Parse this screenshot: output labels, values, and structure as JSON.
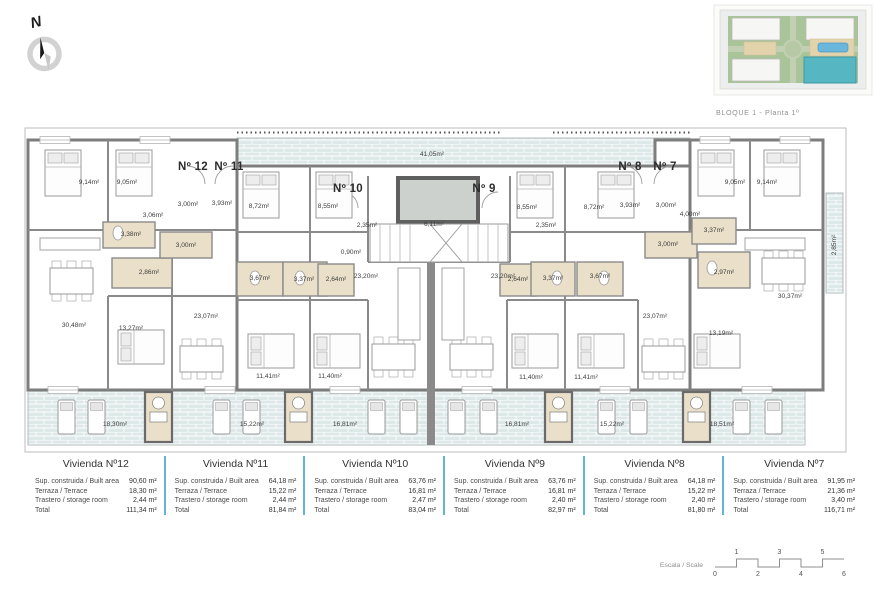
{
  "compass": {
    "letter": "N"
  },
  "site_plan": {
    "caption": "BLOQUE 1 - Planta 1º"
  },
  "colors": {
    "wall": "#7d7d7d",
    "terrace_fill": "#dde8e9",
    "bath_fill": "#eadfc8",
    "elevator_fill": "#cdd1cd",
    "table_divider": "#63b4d8",
    "site_green": "#a9c499",
    "site_highlight_teal": "#56b7c3",
    "site_pool_blue": "#69b7dc"
  },
  "plan": {
    "apartment_labels": [
      {
        "text": "Nº 12",
        "x": 193,
        "y": 170
      },
      {
        "text": "Nº 11",
        "x": 229,
        "y": 170
      },
      {
        "text": "Nº 10",
        "x": 348,
        "y": 192
      },
      {
        "text": "Nº 9",
        "x": 484,
        "y": 192
      },
      {
        "text": "Nº 8",
        "x": 630,
        "y": 170
      },
      {
        "text": "Nº 7",
        "x": 665,
        "y": 170
      }
    ],
    "room_labels": [
      {
        "t": "9,14m²",
        "x": 89,
        "y": 184
      },
      {
        "t": "9,05m²",
        "x": 127,
        "y": 184
      },
      {
        "t": "3,06m²",
        "x": 153,
        "y": 217
      },
      {
        "t": "3,00m²",
        "x": 188,
        "y": 206
      },
      {
        "t": "3,93m²",
        "x": 222,
        "y": 205
      },
      {
        "t": "3,38m²",
        "x": 131,
        "y": 236
      },
      {
        "t": "3,00m²",
        "x": 186,
        "y": 247
      },
      {
        "t": "2,86m²",
        "x": 149,
        "y": 274
      },
      {
        "t": "30,48m²",
        "x": 74,
        "y": 327
      },
      {
        "t": "13,27m²",
        "x": 131,
        "y": 330
      },
      {
        "t": "23,07m²",
        "x": 206,
        "y": 318
      },
      {
        "t": "8,72m²",
        "x": 259,
        "y": 208
      },
      {
        "t": "3,67m²",
        "x": 260,
        "y": 280
      },
      {
        "t": "3,37m²",
        "x": 304,
        "y": 281
      },
      {
        "t": "11,41m²",
        "x": 268,
        "y": 378
      },
      {
        "t": "8,55m²",
        "x": 328,
        "y": 208
      },
      {
        "t": "2,35m²",
        "x": 367,
        "y": 227
      },
      {
        "t": "0,90m²",
        "x": 351,
        "y": 254
      },
      {
        "t": "2,64m²",
        "x": 336,
        "y": 281
      },
      {
        "t": "23,20m²",
        "x": 366,
        "y": 278
      },
      {
        "t": "41,05m²",
        "x": 432,
        "y": 156
      },
      {
        "t": "6,11m²",
        "x": 434,
        "y": 226
      },
      {
        "t": "2,35m²",
        "x": 546,
        "y": 227
      },
      {
        "t": "23,20m²",
        "x": 503,
        "y": 278
      },
      {
        "t": "2,64m²",
        "x": 518,
        "y": 281
      },
      {
        "t": "3,37m²",
        "x": 553,
        "y": 280
      },
      {
        "t": "11,40m²",
        "x": 330,
        "y": 378
      },
      {
        "t": "11,40m²",
        "x": 531,
        "y": 379
      },
      {
        "t": "8,55m²",
        "x": 527,
        "y": 209
      },
      {
        "t": "8,72m²",
        "x": 594,
        "y": 209
      },
      {
        "t": "3,93m²",
        "x": 630,
        "y": 207
      },
      {
        "t": "3,00m²",
        "x": 666,
        "y": 207
      },
      {
        "t": "3,67m²",
        "x": 600,
        "y": 278
      },
      {
        "t": "3,00m²",
        "x": 668,
        "y": 246
      },
      {
        "t": "23,07m²",
        "x": 655,
        "y": 318
      },
      {
        "t": "11,41m²",
        "x": 586,
        "y": 379
      },
      {
        "t": "3,37m²",
        "x": 714,
        "y": 232
      },
      {
        "t": "4,00m²",
        "x": 690,
        "y": 216
      },
      {
        "t": "9,05m²",
        "x": 735,
        "y": 184
      },
      {
        "t": "9,14m²",
        "x": 767,
        "y": 184
      },
      {
        "t": "2,97m²",
        "x": 724,
        "y": 274
      },
      {
        "t": "30,37m²",
        "x": 790,
        "y": 298
      },
      {
        "t": "13,19m²",
        "x": 721,
        "y": 335
      },
      {
        "t": "2,85m²",
        "x": 836,
        "y": 245,
        "r": -90
      },
      {
        "t": "18,30m²",
        "x": 115,
        "y": 426
      },
      {
        "t": "15,22m²",
        "x": 252,
        "y": 426
      },
      {
        "t": "16,81m²",
        "x": 345,
        "y": 426
      },
      {
        "t": "16,81m²",
        "x": 517,
        "y": 426
      },
      {
        "t": "15,22m²",
        "x": 612,
        "y": 426
      },
      {
        "t": "18,51m²",
        "x": 722,
        "y": 426
      }
    ]
  },
  "table": {
    "row_labels": [
      "Sup. construida / Built area",
      "Terraza / Terrace",
      "Trastero / storage room",
      "Total"
    ],
    "units": [
      {
        "name": "Vivienda Nº12",
        "values": [
          "90,60 m²",
          "18,30 m²",
          "2,44 m²",
          "111,34 m²"
        ]
      },
      {
        "name": "Vivienda Nº11",
        "values": [
          "64,18 m²",
          "15,22 m²",
          "2,44 m²",
          "81,84 m²"
        ]
      },
      {
        "name": "Vivienda Nº10",
        "values": [
          "63,76 m²",
          "16,81 m²",
          "2,47 m²",
          "83,04 m²"
        ]
      },
      {
        "name": "Vivienda Nº9",
        "values": [
          "63,76 m²",
          "16,81 m²",
          "2,40 m²",
          "82,97 m²"
        ]
      },
      {
        "name": "Vivienda Nº8",
        "values": [
          "64,18 m²",
          "15,22 m²",
          "2,40 m²",
          "81,80 m²"
        ]
      },
      {
        "name": "Vivienda Nº7",
        "values": [
          "91,95 m²",
          "21,36 m²",
          "3,40 m²",
          "116,71 m²"
        ]
      }
    ]
  },
  "scale_bar": {
    "label": "Escala / Scale",
    "top_numbers": [
      "1",
      "3",
      "5"
    ],
    "bottom_numbers": [
      "0",
      "2",
      "4",
      "6"
    ]
  }
}
